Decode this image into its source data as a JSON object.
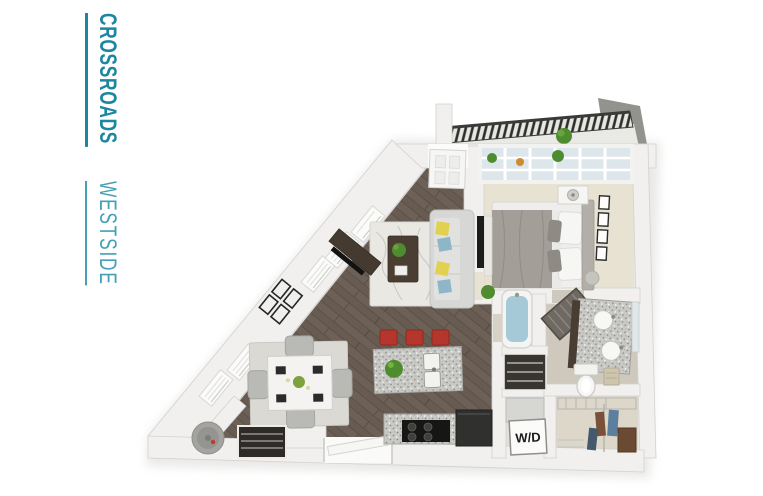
{
  "logo": {
    "primary": "CROSSROADS",
    "secondary": "WESTSIDE",
    "primary_color": "#1d86a0",
    "secondary_color": "#45a1b6"
  },
  "floor_plan": {
    "wd_label": "W/D",
    "colors": {
      "wall": "#f1f0ee",
      "wall_shade": "#d2d1ce",
      "wood_floor": "#6d6057",
      "carpet": "#e8e2d3",
      "bath_floor": "#cfc9bd",
      "tub_room_floor": "#d8d2c6",
      "closet_floor": "#ddd7ca",
      "granite": "#c9c9c5",
      "stool_red": "#b5362c",
      "tub_water": "#a6c9d8",
      "railing_dark": "#2e2e2b",
      "plant_green": "#4f8c2f",
      "sofa_gray": "#d7d7d5",
      "table_brown": "#4a3e33",
      "pillow_yellow": "#e2d04f",
      "pillow_blue": "#8fb6c6",
      "closet_dark": "#2e2a27"
    }
  }
}
